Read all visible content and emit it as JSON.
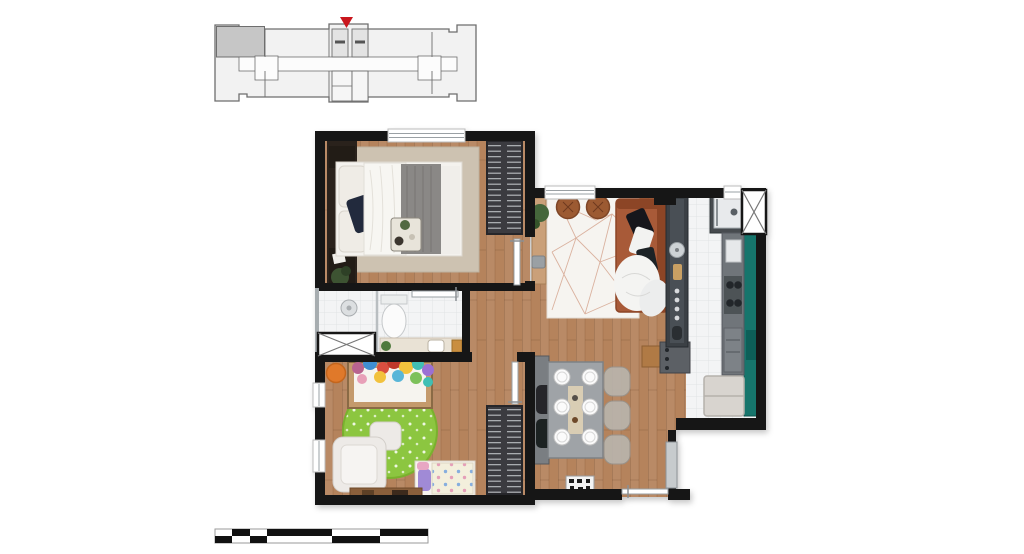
{
  "title": "apartment-floor-plan-render",
  "colors": {
    "wall": "#161616",
    "wood_floor": "#b5835c",
    "wood_dark": "#9c6f4a",
    "tile": "#f3f4f5",
    "tile_line": "#e0e3e5",
    "rug_beige": "#cdc2b1",
    "rug_white": "#f6f4f0",
    "rug_line": "#d3a18b",
    "teal": "#17746c",
    "teal_dark": "#115e58",
    "counter_grey": "#70757a",
    "counter_mid": "#4e5257",
    "counter_dark": "#3b3f44",
    "sofa": "#a85a39",
    "sofa_dark": "#8c4527",
    "green_rug": "#8cc63f",
    "green_rug_dark": "#79b12e",
    "orange_pouf": "#e0792c",
    "wardrobe": "#3a3a40",
    "wardrobe_stripe": "#cfd2d6",
    "bed_white": "#f4f2ee",
    "blanket_grey": "#8a8886",
    "pillow_navy": "#232c3d",
    "crib_wood": "#c49a6c",
    "keyplan_fill": "#f2f2f2",
    "keyplan_stroke": "#6e6e6e",
    "keyplan_highlight": "#c6c6c6",
    "arrow_red": "#c9161d",
    "door_leaf": "#ffffff",
    "door_frame": "#9aa0a4",
    "service_door": "#c7cbcd",
    "shaft_fill": "#ffffff",
    "scale_black": "#111111"
  },
  "key_plan": {
    "description": "building-typical-floor-outline",
    "highlighted_unit_position": "top-left",
    "marker": "red-arrow-down-at-core"
  },
  "rooms": [
    {
      "id": "bedroom",
      "furniture": [
        "headboard-panel",
        "double-bed",
        "white-pillows",
        "navy-pillow",
        "grey-blanket",
        "breakfast-tray",
        "beige-rug",
        "wardrobe-hangers",
        "plant",
        "window"
      ]
    },
    {
      "id": "bathroom",
      "furniture": [
        "shower-head",
        "glass-partition",
        "toilet",
        "vanity-counter",
        "sink",
        "duct-shaft-x"
      ]
    },
    {
      "id": "kids-room",
      "furniture": [
        "crib",
        "star-pillows",
        "orange-pouf",
        "green-polka-rug",
        "armchair",
        "ottoman",
        "kids-bed",
        "purple-pillow",
        "wardrobe-hangers",
        "low-shelf",
        "two-windows"
      ]
    },
    {
      "id": "living-room",
      "furniture": [
        "geometric-rug",
        "terracotta-sofa",
        "throw-blanket",
        "round-pouf",
        "round-pouf",
        "console",
        "plant",
        "window"
      ]
    },
    {
      "id": "dining-room",
      "furniture": [
        "dining-table",
        "six-place-settings",
        "three-translucent-chairs",
        "two-black-chairs",
        "grey-sideboard",
        "wood-stool",
        "knob-cabinet",
        "shoe-mat",
        "entrance-door"
      ]
    },
    {
      "id": "kitchen",
      "furniture": [
        "peninsula-counter",
        "round-sink",
        "cutting-board",
        "knobs",
        "microwave-block",
        "duct-shaft-x",
        "counter-run",
        "cooktop-burners",
        "dishwasher",
        "fridge",
        "teal-cabinets",
        "window"
      ]
    }
  ],
  "scale_bar": {
    "rows": 2,
    "small_segments": 4,
    "large_segments": 3,
    "style": "alternating-black-white"
  }
}
